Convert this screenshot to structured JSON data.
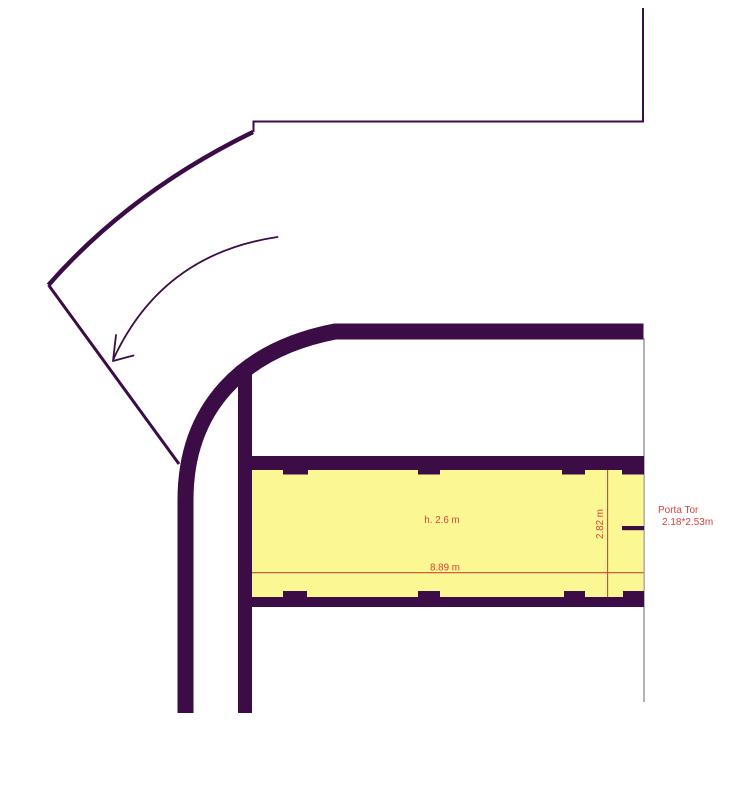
{
  "floor_plan": {
    "garage": {
      "ceiling_height_label": "h. 2.6 m",
      "length_label": "8.89 m",
      "width_label": "2.82 m"
    },
    "door": {
      "label": "Porta Tor",
      "dimensions": "2.18*2.53m"
    },
    "colors": {
      "wall": "#3b0c45",
      "floor": "#fbf893",
      "dim_line": "#c34b38",
      "dim_text": "#d8423e",
      "guide_line": "#a39da8",
      "background": "#ffffff"
    }
  }
}
